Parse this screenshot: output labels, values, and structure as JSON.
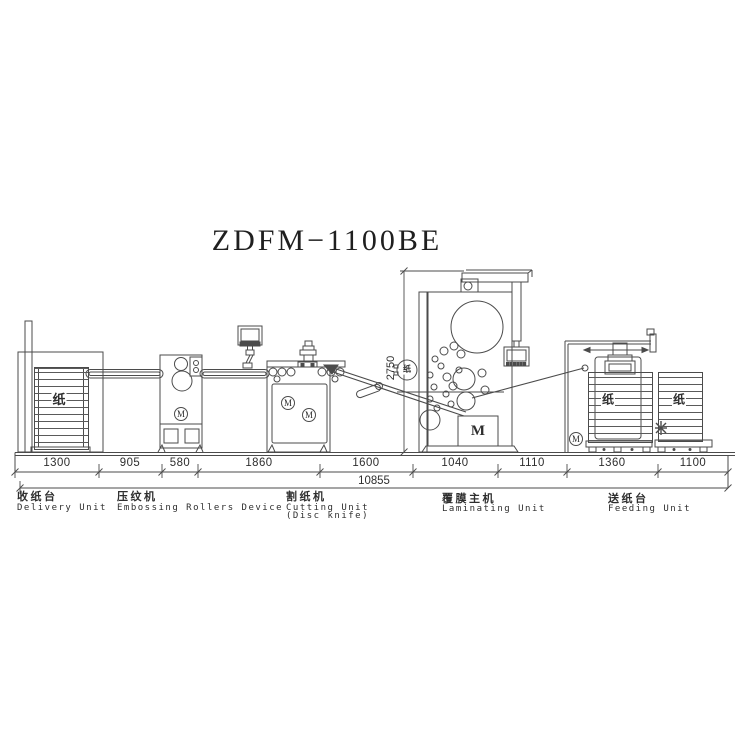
{
  "title": "ZDFM−1100BE",
  "dimensions": {
    "horizontal": [
      "1300",
      "905",
      "580",
      "1860",
      "1600",
      "1040",
      "1110",
      "1360",
      "1100"
    ],
    "total": "10855",
    "height": "2750"
  },
  "units": [
    {
      "zh": "收纸台",
      "en": "Delivery Unit"
    },
    {
      "zh": "压纹机",
      "en": "Embossing Rollers Device"
    },
    {
      "zh": "割纸机",
      "en": "Cutting Unit",
      "en2": "(Disc knife)"
    },
    {
      "zh": "覆膜主机",
      "en": "Laminating Unit"
    },
    {
      "zh": "送纸台",
      "en": "Feeding Unit"
    }
  ],
  "machine_text": {
    "paper": "纸",
    "film": "纸",
    "motor": "M"
  },
  "colors": {
    "line": "#4b4b4b",
    "text": "#2e2e2e",
    "background": "#ffffff"
  }
}
